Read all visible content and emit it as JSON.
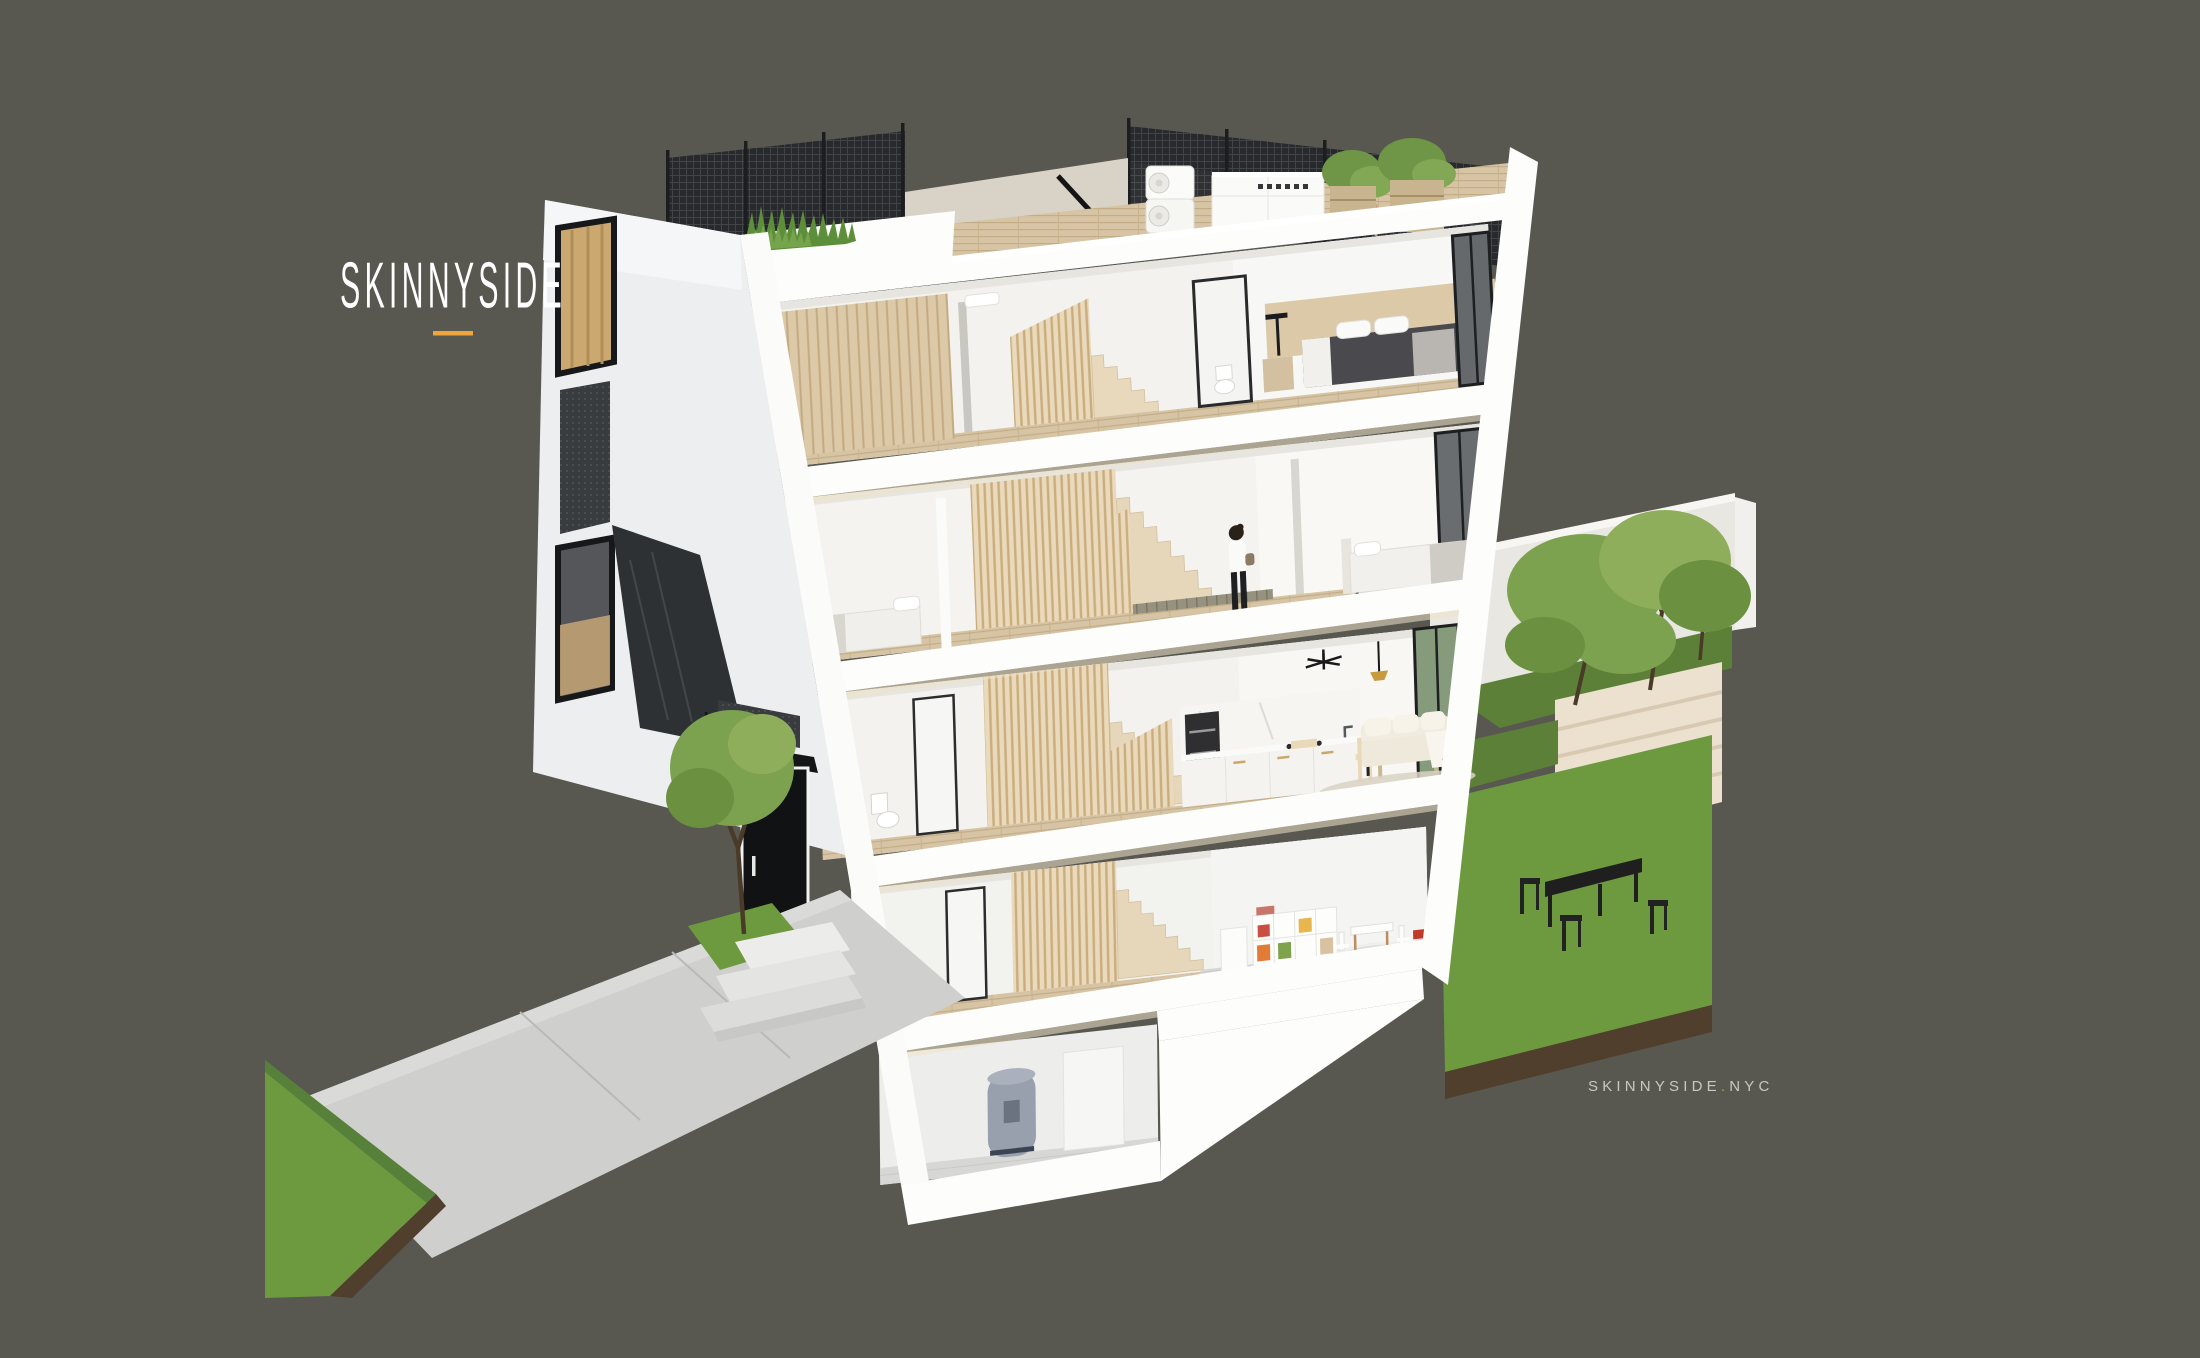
{
  "brand": {
    "logo_text": "SKINNYSIDE"
  },
  "footer": {
    "brand": "SKINNYSIDE",
    "separator": ".",
    "tld": "NYC"
  },
  "colors": {
    "bg": "#585850",
    "accent": "#f0a43c",
    "dot": "#b3a33e",
    "text": "#c7c8c3",
    "grass": "#6d9a3f",
    "grassdark": "#5d8038",
    "soil": "#4f3f2c",
    "wood": "#d6c4a4",
    "woodlight": "#e6d7ba",
    "slat": "#ead9ba",
    "white": "#fdfdfc",
    "offwhite": "#f3f2ef",
    "mesh": "#25272a",
    "glass": "#66696b",
    "concrete": "#cfcfcd",
    "canopy": "#151617",
    "door": "#111214"
  }
}
